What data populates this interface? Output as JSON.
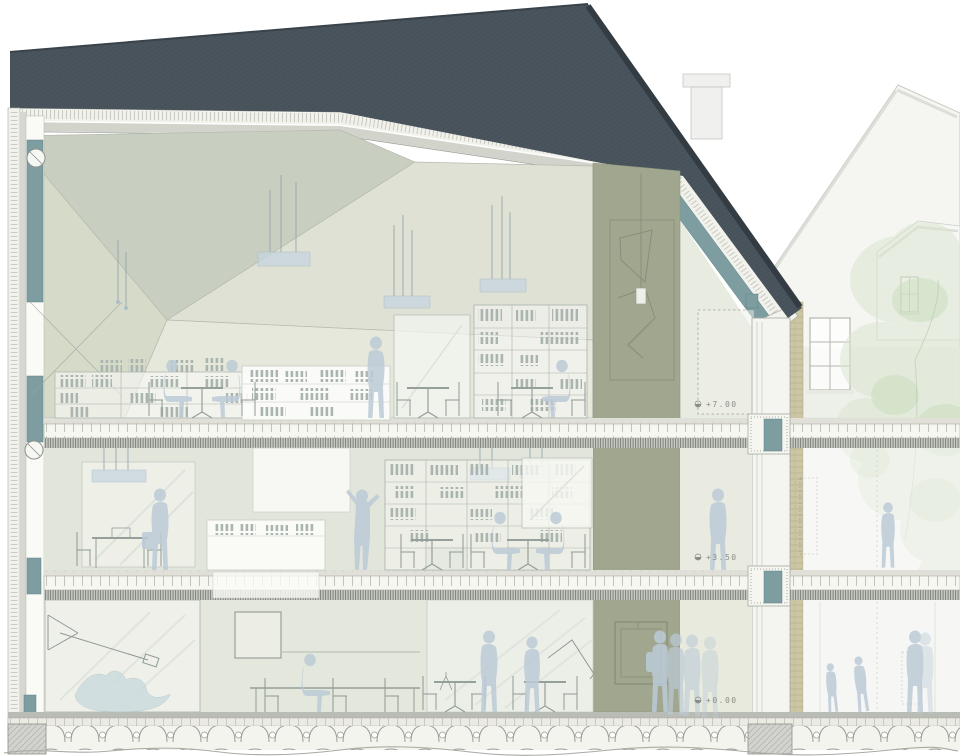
{
  "drawing": {
    "type": "architectural-building-section",
    "levels": [
      {
        "name": "attic",
        "label": "+7.00"
      },
      {
        "name": "first-floor",
        "label": "+3.50"
      },
      {
        "name": "ground-floor",
        "label": "+0.00"
      }
    ],
    "colors": {
      "roof_dark": "#4a545d",
      "roof_hatch": "#3d4750",
      "insulation": "#f2f2ec",
      "ceiling_board": "#d2d4cc",
      "facet_dark": "#c9cfc0",
      "facet_wall": "#d6dac9",
      "facet_mid": "#dee1d4",
      "facet_light": "#e6e8dc",
      "core_wall": "#a1a78f",
      "glazing_frame": "#7d9da1",
      "interior_wall": "#e2e5d9",
      "glass_tint": "#edf0e8",
      "figure_blue": "#bccbd7",
      "tree_green": "#dbe7d1",
      "masonry_tan": "#cdc6a4",
      "background_building": "#f5f6f2",
      "line_grey": "#9aa29a"
    }
  }
}
